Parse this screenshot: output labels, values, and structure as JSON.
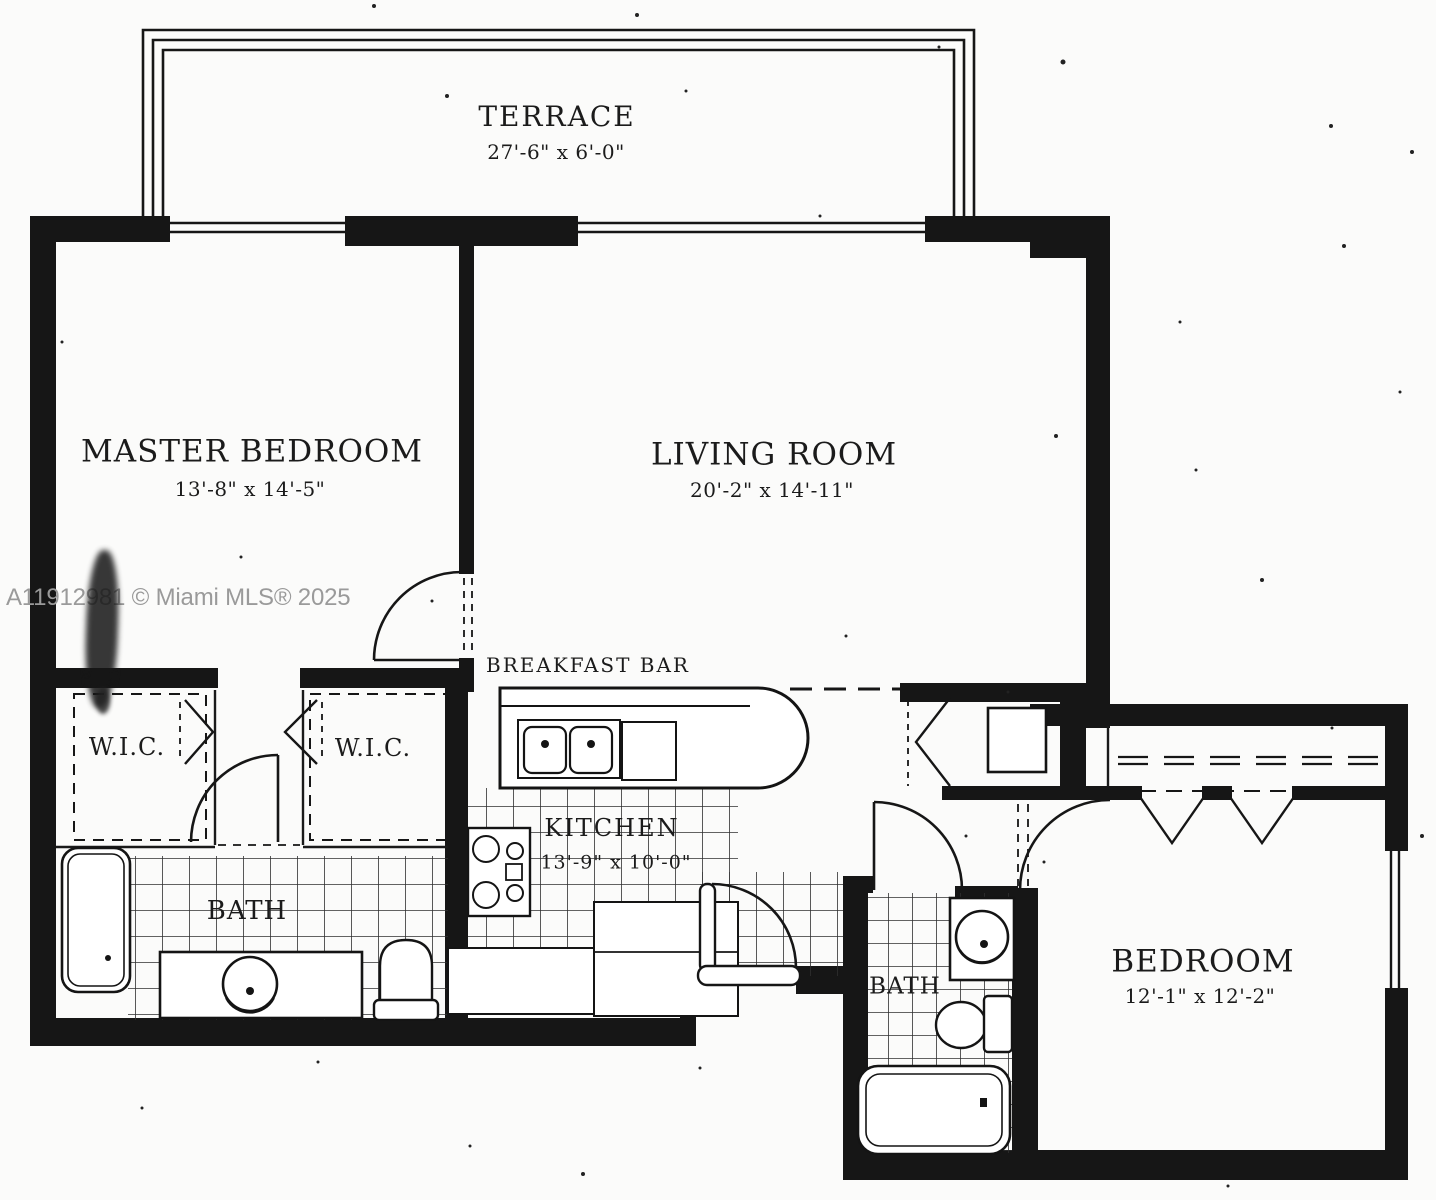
{
  "watermark": {
    "text": "A11912981 © Miami MLS® 2025"
  },
  "rooms": {
    "terrace": {
      "name": "TERRACE",
      "dims": "27'-6\" x 6'-0\""
    },
    "master_bedroom": {
      "name": "MASTER BEDROOM",
      "dims": "13'-8\" x 14'-5\""
    },
    "living_room": {
      "name": "LIVING ROOM",
      "dims": "20'-2\" x 14'-11\""
    },
    "kitchen": {
      "name": "KITCHEN",
      "dims": "13'-9\" x 10'-0\""
    },
    "bedroom": {
      "name": "BEDROOM",
      "dims": "12'-1\" x 12'-2\""
    },
    "wic_left": {
      "name": "W.I.C."
    },
    "wic_right": {
      "name": "W.I.C."
    },
    "master_bath": {
      "name": "BATH"
    },
    "second_bath": {
      "name": "BATH"
    },
    "breakfast_bar": {
      "name": "BREAKFAST BAR"
    }
  },
  "colors": {
    "ink": "#161616",
    "paper": "#fbfbfa",
    "watermark_gray": "#9a9a9a"
  }
}
